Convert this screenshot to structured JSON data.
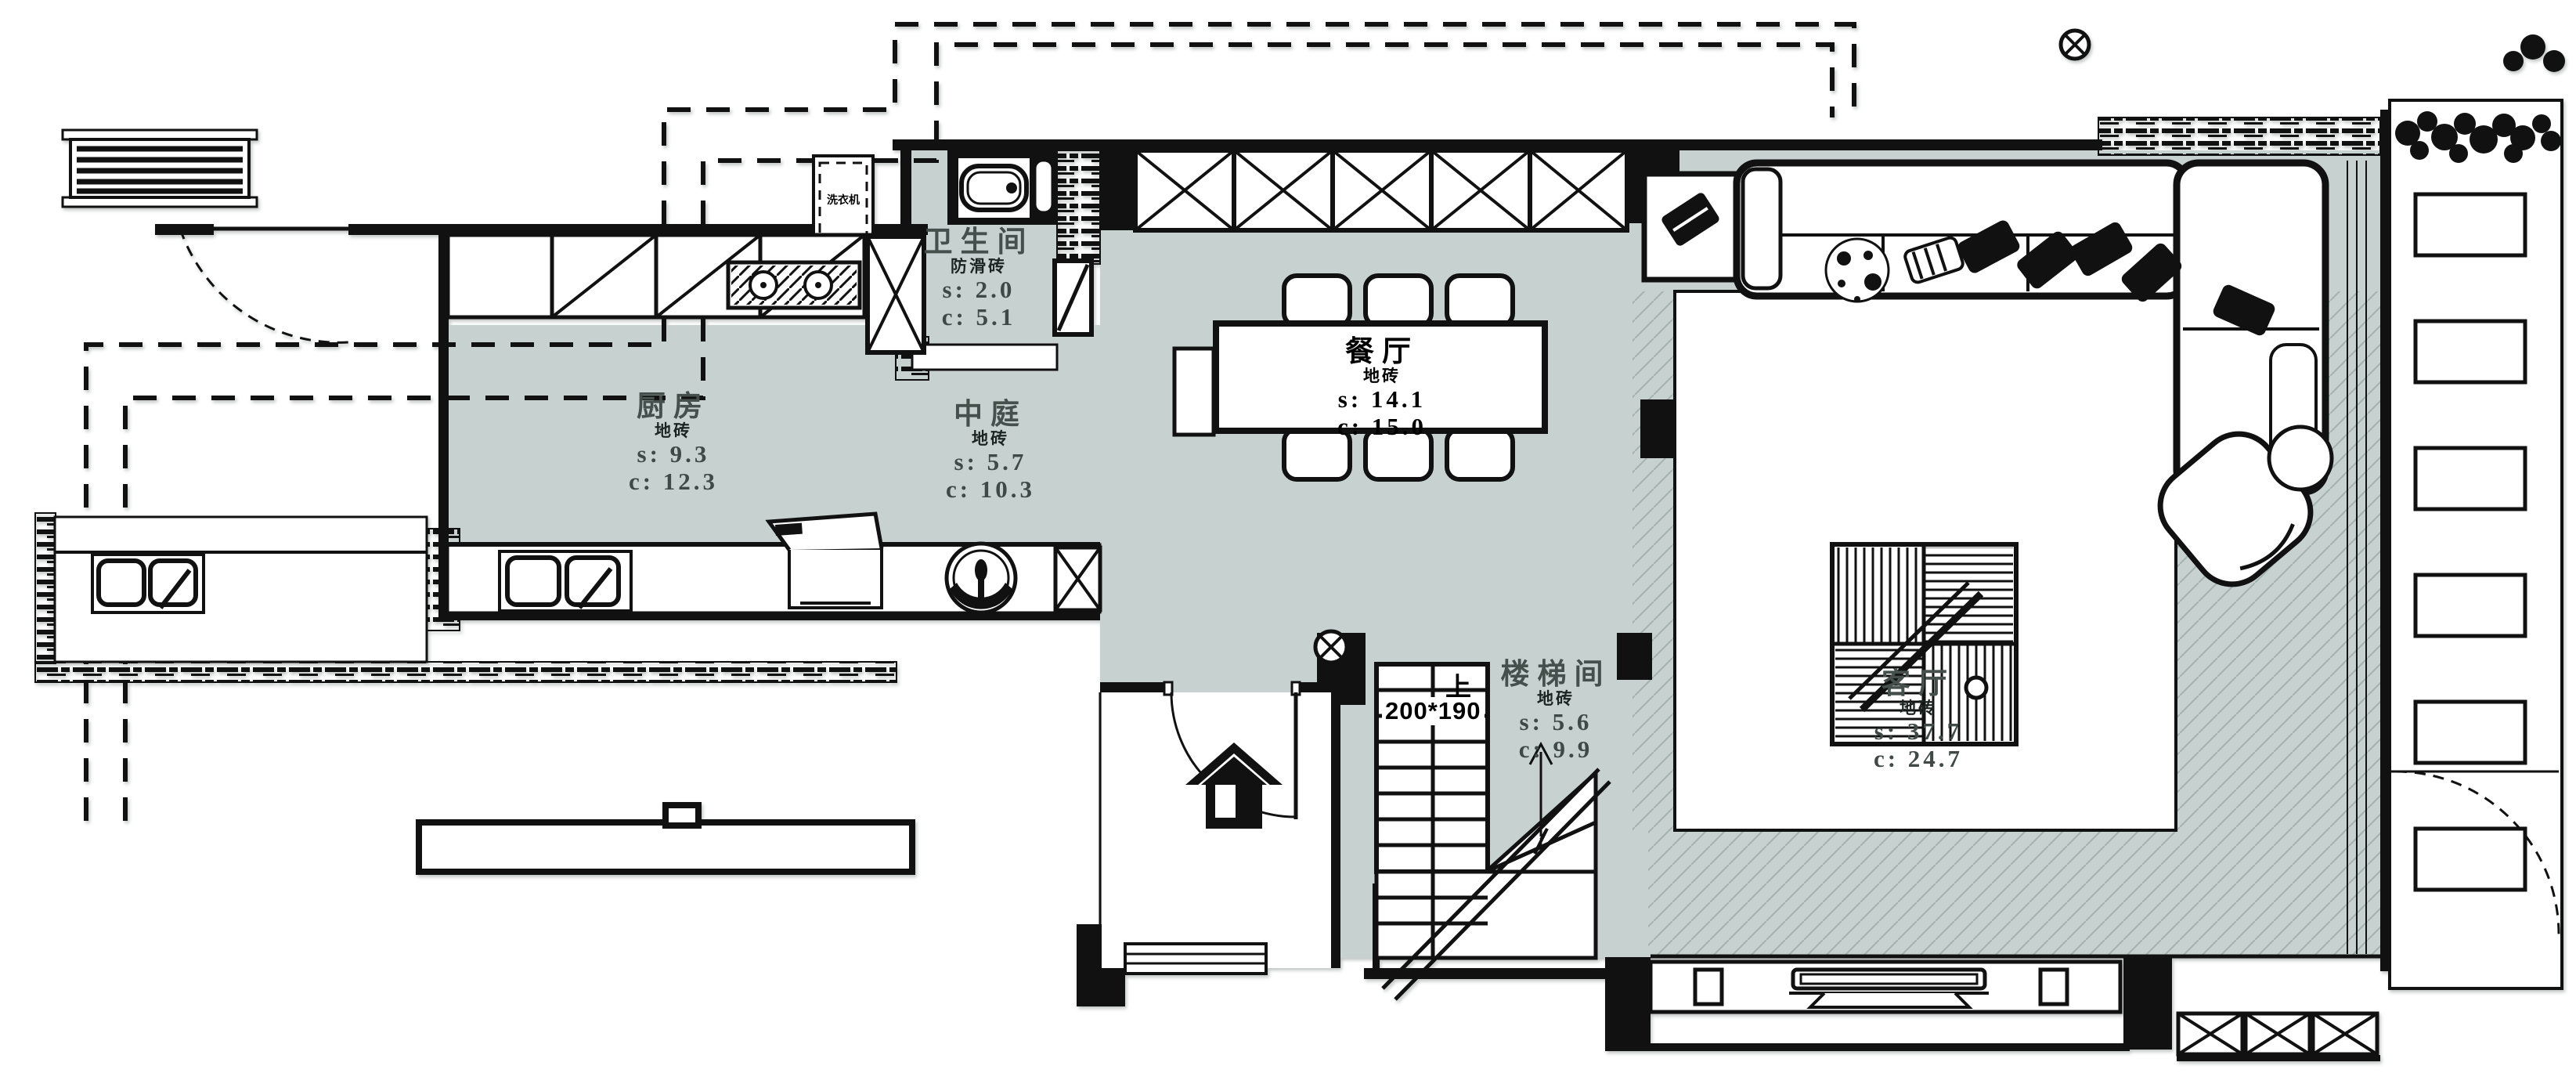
{
  "plan": {
    "colors": {
      "floor": "#c7d1cf",
      "line": "#111111",
      "hatch_light": "#a3b2b0"
    },
    "rooms": [
      {
        "id": "bathroom",
        "name": "卫生间",
        "finish": "防滑砖",
        "s": "s: 2.0",
        "c": "c: 5.1"
      },
      {
        "id": "kitchen",
        "name": "厨房",
        "finish": "地砖",
        "s": "s: 9.3",
        "c": "c: 12.3"
      },
      {
        "id": "atrium",
        "name": "中庭",
        "finish": "地砖",
        "s": "s: 5.7",
        "c": "c: 10.3"
      },
      {
        "id": "dining",
        "name": "餐厅",
        "finish": "地砖",
        "s": "s: 14.1",
        "c": "c: 15.0"
      },
      {
        "id": "stairwell",
        "name": "楼梯间",
        "finish": "地砖",
        "s": "s: 5.6",
        "c": "c: 9.9"
      },
      {
        "id": "living",
        "name": "客厅",
        "finish": "地砖",
        "s": "s: 37.7",
        "c": "c: 24.7"
      }
    ],
    "stairs": {
      "up_label": "上",
      "tread_label": "200*190"
    },
    "appliances": {
      "washer": "洗衣机"
    }
  }
}
